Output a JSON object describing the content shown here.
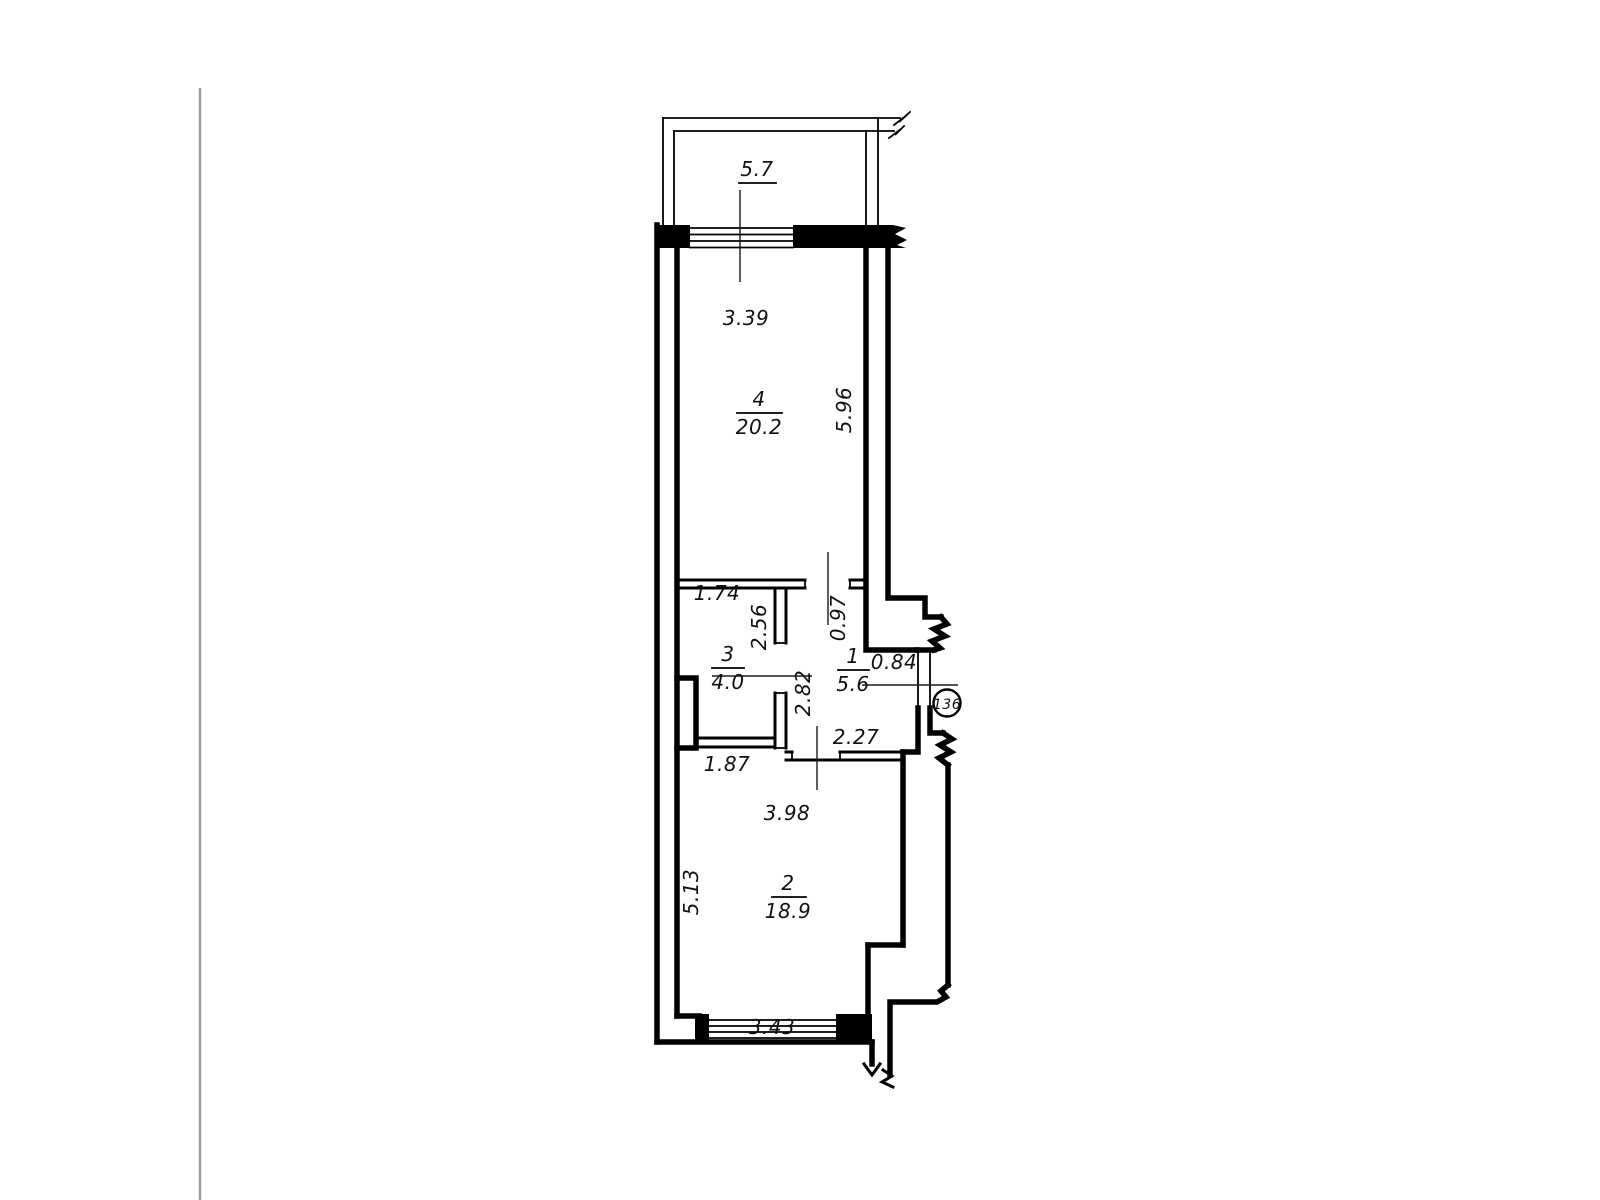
{
  "page": {
    "background": "#ffffff",
    "edge_line_color": "#9a9a9a",
    "line_color": "#000000"
  },
  "plan": {
    "apartment_number": "136",
    "balcony": {
      "area": "5.7"
    },
    "rooms": [
      {
        "number": "4",
        "area": "20.2"
      },
      {
        "number": "3",
        "area": "4.0"
      },
      {
        "number": "1",
        "area": "5.6"
      },
      {
        "number": "2",
        "area": "18.9"
      }
    ],
    "dimensions": {
      "room4_width": "3.39",
      "room4_depth": "5.96",
      "room3_width": "1.74",
      "room3_depth": "2.56",
      "room1_right_top": "0.97",
      "room1_left": "2.82",
      "room1_bottom": "2.27",
      "entrance_door": "0.84",
      "room2_top_left": "1.87",
      "room2_width": "3.98",
      "room2_depth": "5.13",
      "bottom_window": "3.43"
    }
  }
}
